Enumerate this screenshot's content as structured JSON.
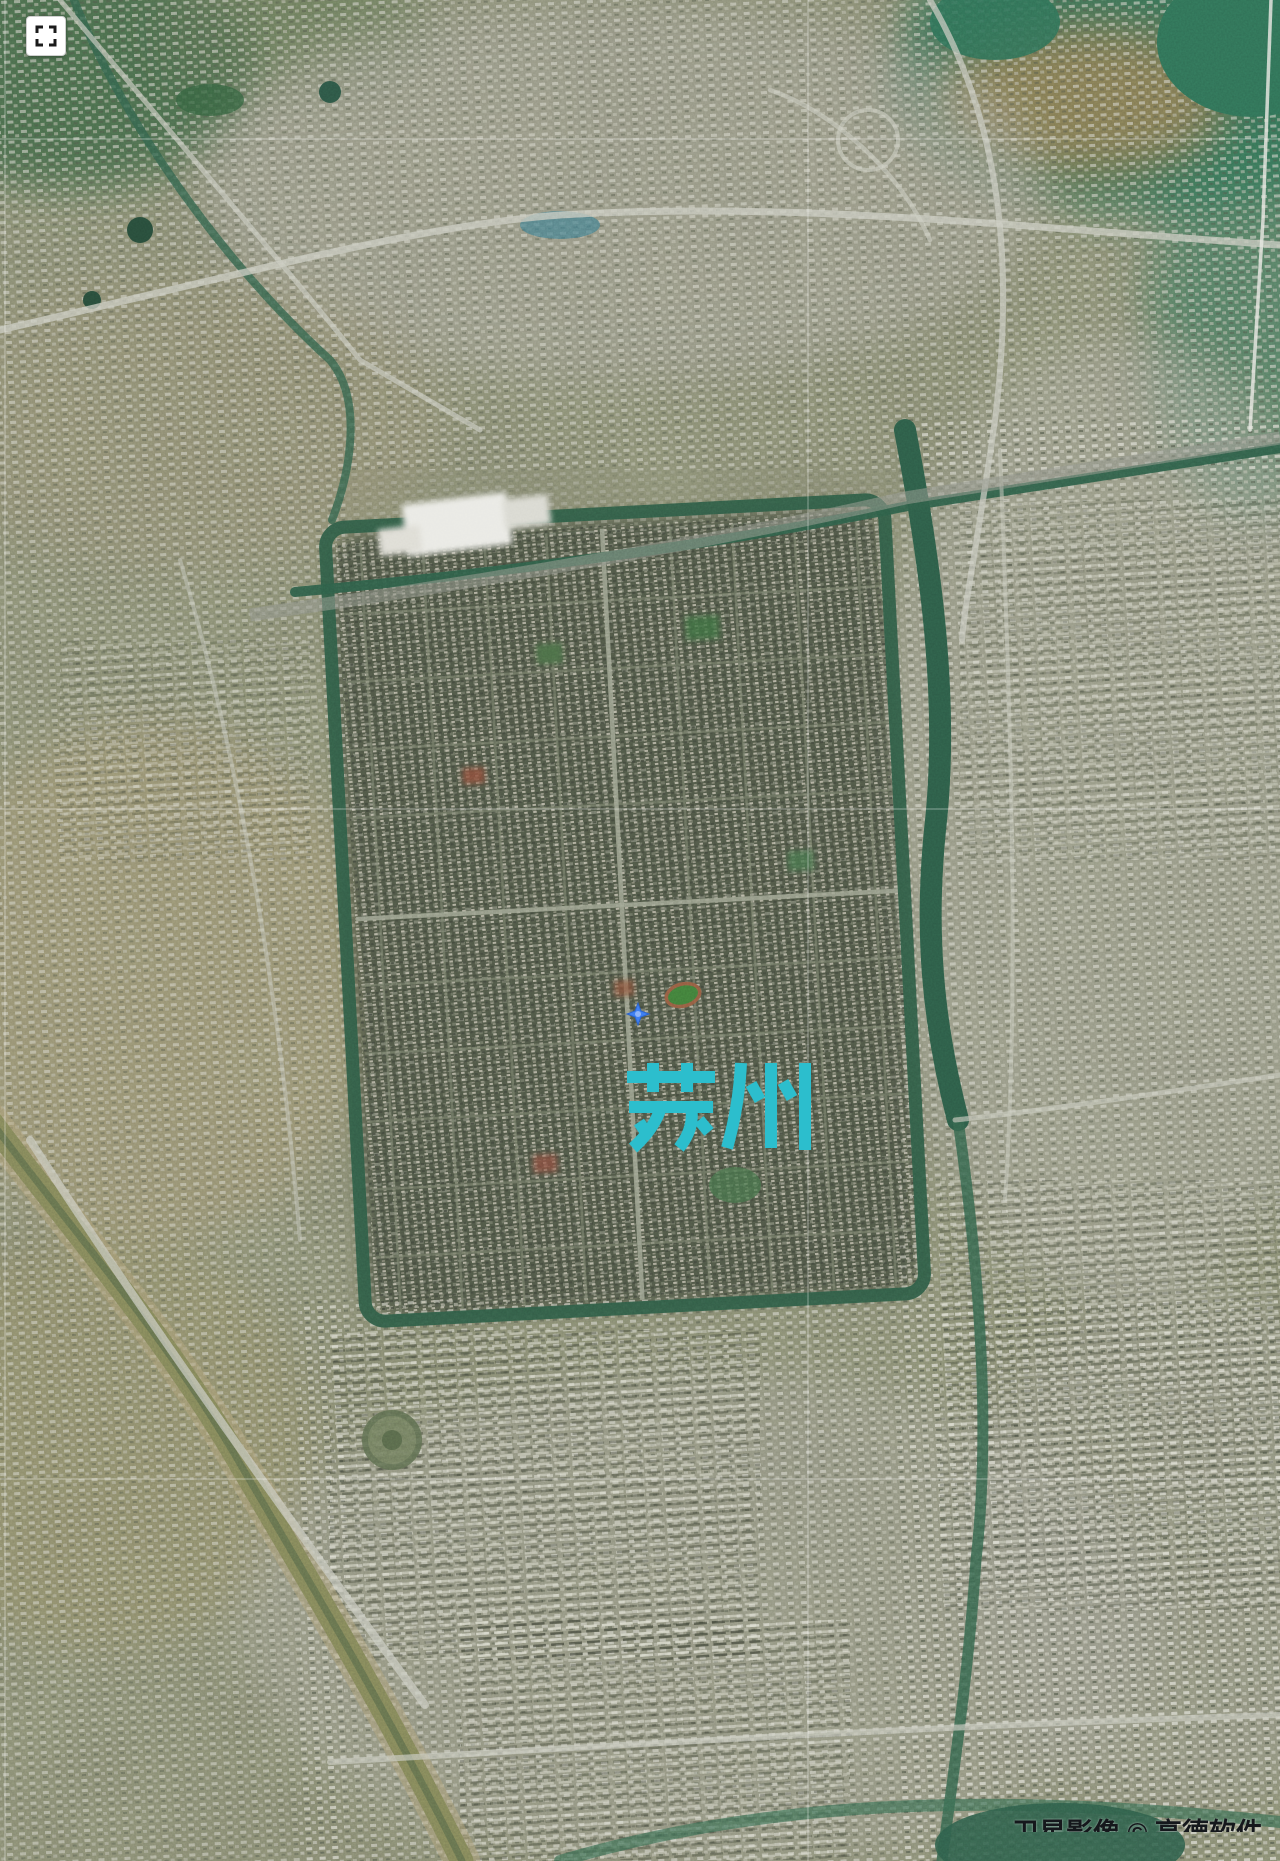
{
  "map": {
    "view_type": "satellite",
    "city_label": {
      "text": "苏州",
      "color": "#2cbecd"
    },
    "marker": {
      "shape": "four-point-star",
      "color": "#3f80f2",
      "x": 638,
      "y": 1014
    },
    "graticule": {
      "color": "#ffffff",
      "vertical_x": [
        5,
        808
      ],
      "horizontal_y": [
        139,
        809,
        1479
      ]
    },
    "attribution": {
      "text": "卫星影像 © 高德软件",
      "clipped": true
    }
  },
  "controls": {
    "fullscreen_button": {
      "icon": "fullscreen-expand-icon",
      "background": "#ffffff",
      "icon_color": "#1b1b1b"
    }
  },
  "palette": {
    "base_land": "#7f826c",
    "old_city": "#4a5143",
    "water_dark": "#2d5b46",
    "lake_teal": "#2f6e55",
    "canal_muddy": "#7f8257",
    "urban_light": "#dcdcd2",
    "road_light": "#c9cbc0"
  }
}
